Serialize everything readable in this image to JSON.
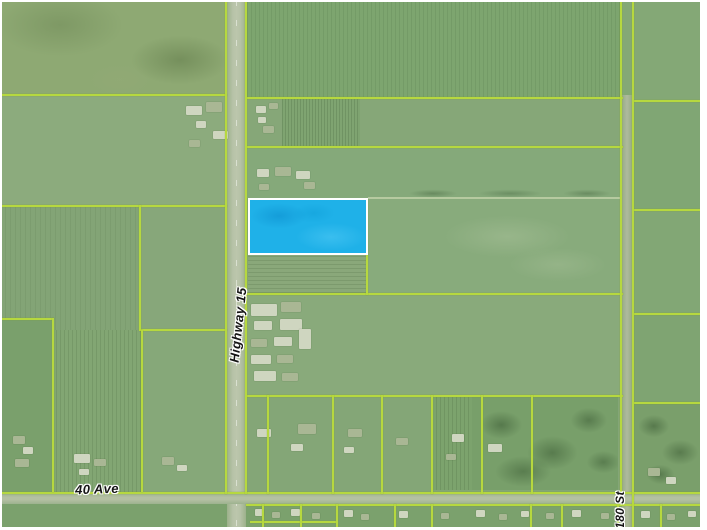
{
  "map": {
    "labels": {
      "highway": "Highway 15",
      "avenue": "40 Ave",
      "street": "180 St"
    },
    "highlighted_parcel": {
      "fill_color": "#1fb1e8",
      "border_color": "#ffffff"
    },
    "colors": {
      "parcel_line": "#b6d83f",
      "field_green": "#86a778",
      "road_surface": "#b4c0a3",
      "page_background": "#ffffff"
    }
  }
}
